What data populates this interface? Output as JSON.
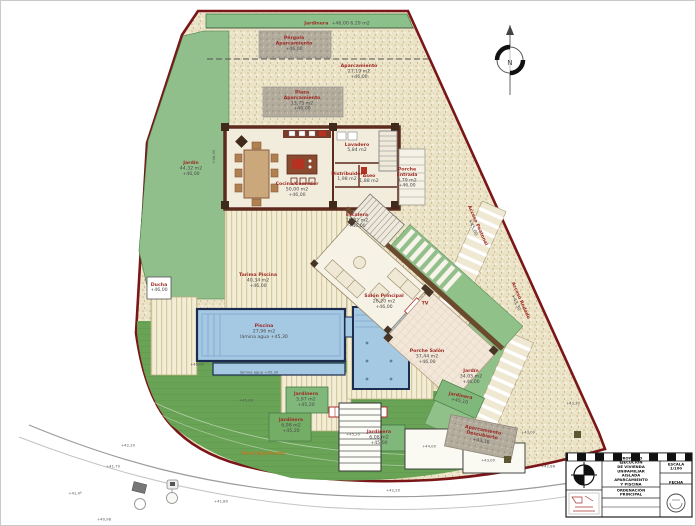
{
  "colors": {
    "boundary": "#7a1518",
    "lawn": "#69a355",
    "garden": "#90bf8c",
    "planter": "#7fb87a",
    "pool_fill": "#a5c8e3",
    "pool_border": "#1b2c4e",
    "gravel": "#ece4c9",
    "wall": "#5d2a1e",
    "label_red": "#9e2b25",
    "label_gray": "#4a4a4a",
    "talud_orange": "#c07820"
  },
  "north": {
    "label": "N"
  },
  "labels": {
    "jardinera_top": {
      "name": "Jardinera",
      "value": "+46,00      6,29 m2"
    },
    "pergola": {
      "name": "Pérgola\nAparcamiento",
      "value": "+46,00"
    },
    "plaza": {
      "name": "Plaza\nAparcamiento",
      "value": "13,75 m2\n+46,00"
    },
    "aparc_right": {
      "name": "Aparcamiento",
      "value": "27,19 m2\n+46,00"
    },
    "jardin_left": {
      "name": "Jardín",
      "value": "44,32 m2\n+46,00"
    },
    "ducha": {
      "name": "Ducha",
      "value": "+46,00"
    },
    "cocina": {
      "name": "Cocina/Comedor",
      "value": "50,00 m2\n+46,00"
    },
    "lavadero": {
      "name": "Lavadero",
      "value": "5,84 m2"
    },
    "distribuidor": {
      "name": "Distribuidor",
      "value": "1,98 m2"
    },
    "aseo": {
      "name": "Aseo",
      "value": "1,88 m2"
    },
    "porche_entrada": {
      "name": "Porche\nEntrada",
      "value": "6,79 m2\n+46,00"
    },
    "escalera": {
      "name": "Escalera",
      "value": "16,82 m2\n+46,00"
    },
    "salon": {
      "name": "Salón Principal",
      "value": "26,20 m2\n+46,00"
    },
    "tv": {
      "name": "TV",
      "value": ""
    },
    "porche_salon": {
      "name": "Porche Salón",
      "value": "37,44 m2\n+46,00"
    },
    "tarima": {
      "name": "Tarima Piscina",
      "value": "40,34 m2\n+46,00"
    },
    "piscina": {
      "name": "Piscina",
      "value": "27,96 m2\nlámina agua +45,30"
    },
    "lamina": {
      "name": "",
      "value": "lámina agua +45,30"
    },
    "jardin_right": {
      "name": "Jardín",
      "value": "34,05 m2\n+46,00"
    },
    "jardinera_strip": {
      "name": "Jardinera",
      "value": "+45,10"
    },
    "jardinera_1": {
      "name": "Jardinera",
      "value": "5,97 m2\n+45,20"
    },
    "jardinera_2": {
      "name": "Jardinera",
      "value": "6,98 m2\n+45,20"
    },
    "jardinera_3": {
      "name": "Jardinera",
      "value": "6,08 m2\n+45,00"
    },
    "acceso_peatonal": {
      "name": "Acceso Peatonal",
      "value": "+45,00"
    },
    "acceso_rodado": {
      "name": "Acceso Rodado",
      "value": "+43,30"
    },
    "talud": {
      "name": "Talud Ajardinado",
      "value": ""
    },
    "aparc_desc": {
      "name": "Aparcamiento\nDescubierto",
      "value": "+43,30"
    }
  },
  "elev": {
    "e1": "+46,00",
    "e2": "+45,00",
    "e3": "+45,20",
    "e4": "+44,00",
    "e5": "+43,00",
    "e6": "+43,30",
    "e7": "+42,86",
    "e8": "+41,70",
    "e9": "+41,4º",
    "e10": "+40,98",
    "e11": "+41,80",
    "e12": "+42,20",
    "e13": "+43,00",
    "e14": "+42,20",
    "e15": "+46,00"
  },
  "titleblock": {
    "title": "PROYECTO EJECUCIÓN\nDE VIVIENDA UNIFAMILIAR AISLADA\nAPARCAMIENTO Y PISCINA",
    "subtitle": "ORDENACIÓN PRINCIPAL",
    "scale": "ESCALA 1/100",
    "date": "FECHA"
  }
}
